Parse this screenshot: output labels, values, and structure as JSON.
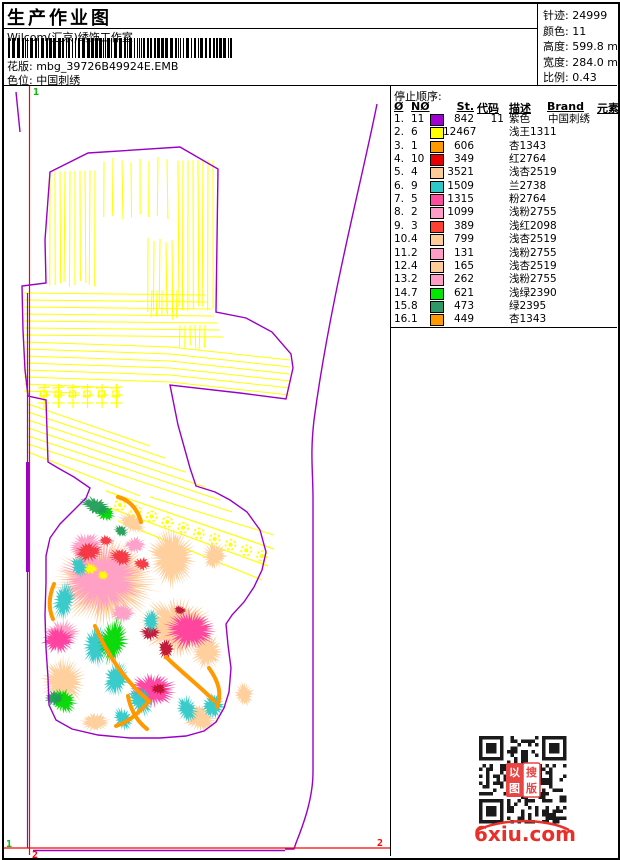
{
  "header": {
    "title": "生产作业图",
    "subtitle": "Wilcom(汇京)绣饰工作室",
    "pattern_label": "花版:",
    "pattern_value": "mbg_39726B49924E.EMB",
    "colorway_label": "色位:",
    "colorway_value": "中国刺绣"
  },
  "info": [
    {
      "label": "针迹",
      "value": "24999"
    },
    {
      "label": "颜色",
      "value": "11"
    },
    {
      "label": "高度",
      "value": "599.8 mm"
    },
    {
      "label": "宽度",
      "value": "284.0 mm"
    },
    {
      "label": "比例",
      "value": "0.43"
    }
  ],
  "stop_table": {
    "title": "停止顺序:",
    "headers": [
      "Ø",
      "NØ",
      "St.",
      "代码",
      "描述",
      "Brand",
      "元素"
    ],
    "rows": [
      {
        "no": "1.",
        "needle": "11",
        "color": "#A000D0",
        "st": "842",
        "code": "11",
        "desc": "紫色",
        "brand": "中国刺绣"
      },
      {
        "no": "2.",
        "needle": "6",
        "color": "#FFFF00",
        "st": "12467",
        "code": "",
        "desc": "浅王1311",
        "brand": ""
      },
      {
        "no": "3.",
        "needle": "1",
        "color": "#FF9900",
        "st": "606",
        "code": "",
        "desc": "杏1343",
        "brand": ""
      },
      {
        "no": "4.",
        "needle": "10",
        "color": "#E80000",
        "st": "349",
        "code": "",
        "desc": "红2764",
        "brand": ""
      },
      {
        "no": "5.",
        "needle": "4",
        "color": "#FFCC99",
        "st": "3521",
        "code": "",
        "desc": "浅杏2519",
        "brand": ""
      },
      {
        "no": "6.",
        "needle": "9",
        "color": "#2FC8C8",
        "st": "1509",
        "code": "",
        "desc": "兰2738",
        "brand": ""
      },
      {
        "no": "7.",
        "needle": "5",
        "color": "#FF4D9E",
        "st": "1315",
        "code": "",
        "desc": "粉2764",
        "brand": ""
      },
      {
        "no": "8.",
        "needle": "2",
        "color": "#FF9DC6",
        "st": "1099",
        "code": "",
        "desc": "浅粉2755",
        "brand": ""
      },
      {
        "no": "9.",
        "needle": "3",
        "color": "#FF4033",
        "st": "389",
        "code": "",
        "desc": "浅红2098",
        "brand": ""
      },
      {
        "no": "10.",
        "needle": "4",
        "color": "#FFCC99",
        "st": "799",
        "code": "",
        "desc": "浅杏2519",
        "brand": ""
      },
      {
        "no": "11.",
        "needle": "2",
        "color": "#FF9DC6",
        "st": "131",
        "code": "",
        "desc": "浅粉2755",
        "brand": ""
      },
      {
        "no": "12.",
        "needle": "4",
        "color": "#FFCC99",
        "st": "165",
        "code": "",
        "desc": "浅杏2519",
        "brand": ""
      },
      {
        "no": "13.",
        "needle": "2",
        "color": "#FF9DC6",
        "st": "262",
        "code": "",
        "desc": "浅粉2755",
        "brand": ""
      },
      {
        "no": "14.",
        "needle": "7",
        "color": "#00E800",
        "st": "621",
        "code": "",
        "desc": "浅绿2390",
        "brand": ""
      },
      {
        "no": "15.",
        "needle": "8",
        "color": "#2E9966",
        "st": "473",
        "code": "",
        "desc": "绿2395",
        "brand": ""
      },
      {
        "no": "16.",
        "needle": "1",
        "color": "#FF9900",
        "st": "449",
        "code": "",
        "desc": "杏1343",
        "brand": ""
      }
    ]
  },
  "watermark": "6xiu.com",
  "qr": {
    "stamp_tl": "以",
    "stamp_tr": "搜",
    "stamp_bl": "图",
    "stamp_br": "版"
  },
  "design": {
    "outline_color": "#9A00C8",
    "hatch_color": "#FFFF00",
    "guide_red": "#FF0000",
    "marker_green": "#00BB00",
    "outline_path": "M50,172 L88,153 L180,147 L218,169 L216,312 L246,318 L272,332 L291,354 L293,368 L286,399 L240,393 L170,385 L178,425 L190,468 L196,486 L215,492 L230,500 L247,512 L260,530 L266,552 L262,570 L254,587 L244,602 L232,615 L226,624 L228,645 L231,668 L229,692 L224,708 L216,722 L204,731 L186,736 L160,738 L130,738 L98,735 L72,729 L56,720 L49,705 L48,678 L46,648 L45,615 L46,582 L46,556 L50,538 L60,524 L74,510 L86,498 L90,488 L74,477 L58,468 L48,462 L47,430 L46,400 L28,396 L25,370 L23,330 L22,286 L46,283 L45,240 L50,172 Z",
    "right_curve": "M377,104 C362,180 330,300 314,420 C310,455 313,470 313,500 L313,772 C313,800 302,828 296,843 L294,849 L285,849",
    "purple_dash_top": "M16,92 L20,132",
    "purple_vline": {
      "x": 27.5,
      "y1": 293,
      "y2": 848,
      "thick_y1": 462,
      "thick_y2": 572
    },
    "red_vline": {
      "x": 29.5,
      "y1": 86,
      "y2": 855
    },
    "red_hline": {
      "y": 848,
      "x1": 4,
      "x2": 390
    },
    "purple_hline": {
      "y": 850.5,
      "x1": 33,
      "x2": 285
    },
    "vhatch": [
      {
        "x0": 50,
        "x1": 96,
        "step": 5,
        "y0": 170,
        "y1": 287
      },
      {
        "x0": 178,
        "x1": 214,
        "step": 5,
        "y0": 155,
        "y1": 311
      },
      {
        "x0": 148,
        "x1": 173,
        "step": 6,
        "y0": 237,
        "y1": 313
      },
      {
        "x0": 104,
        "x1": 168,
        "step": 9,
        "y0": 157,
        "y1": 220
      },
      {
        "x0": 152,
        "x1": 178,
        "step": 5,
        "y0": 289,
        "y1": 320
      },
      {
        "x0": 180,
        "x1": 206,
        "step": 5,
        "y0": 320,
        "y1": 350
      }
    ],
    "hhatch": {
      "count": 7,
      "y0": 293,
      "dy": 7,
      "x0": 24,
      "x1": 205,
      "dx1": 3
    },
    "diag_band": {
      "count": 6,
      "y0": 342,
      "dy": 7,
      "x0": 24,
      "mx": 170,
      "x1": 290,
      "mdy": 5,
      "edy": 18
    },
    "short_lines": [
      [
        24,
        384,
        120,
        388
      ],
      [
        24,
        391,
        80,
        393
      ]
    ],
    "diag_lower": [
      [
        28,
        404,
        150,
        446
      ],
      [
        28,
        412,
        165,
        458
      ],
      [
        28,
        420,
        185,
        472
      ],
      [
        28,
        428,
        205,
        487
      ],
      [
        28,
        436,
        220,
        500
      ],
      [
        28,
        444,
        232,
        512
      ],
      [
        28,
        452,
        140,
        496
      ],
      [
        150,
        497,
        274,
        535
      ]
    ],
    "dollar_band": {
      "edges": [
        [
          106,
          491,
          274,
          549
        ],
        [
          110,
          508,
          268,
          566
        ],
        [
          118,
          521,
          262,
          580
        ]
      ],
      "rosette_line": [
        120,
        505,
        262,
        556
      ],
      "rosette_count": 10
    },
    "glyph_row": {
      "x0": 38,
      "y0": 384,
      "count": 6,
      "step": 14.5,
      "h": 26
    },
    "markers": [
      {
        "t": "1",
        "x": 33,
        "y": 95,
        "c": "#00BB00"
      },
      {
        "t": "1",
        "x": 6,
        "y": 847,
        "c": "#00BB00"
      },
      {
        "t": "2",
        "x": 32,
        "y": 858,
        "c": "#FF0000"
      },
      {
        "t": "2",
        "x": 377,
        "y": 846,
        "c": "#FF0000"
      }
    ],
    "stems_color": "#FF9900",
    "stems": [
      "M118,497 C130,500 138,510 141,522",
      "M95,626 C108,656 126,682 149,701",
      "M149,701 C138,714 128,722 116,726",
      "M166,657 C186,676 204,690 214,701",
      "M54,584 C49,596 48,608 53,619",
      "M209,668 C219,682 222,694 217,707",
      "M128,696 C131,712 138,722 147,729"
    ],
    "blobs": [
      [
        "#FFCC99",
        105,
        582,
        54,
        46,
        0
      ],
      [
        "#FFCC99",
        178,
        628,
        40,
        30,
        15
      ],
      [
        "#FFCC99",
        172,
        558,
        24,
        32,
        -10
      ],
      [
        "#FFCC99",
        63,
        682,
        22,
        27,
        0
      ],
      [
        "#FFCC99",
        200,
        718,
        19,
        14,
        20
      ],
      [
        "#FFCC99",
        214,
        556,
        13,
        15,
        0
      ],
      [
        "#FFCC99",
        244,
        694,
        10,
        13,
        0
      ],
      [
        "#FFCC99",
        132,
        523,
        15,
        10,
        30
      ],
      [
        "#FFCC99",
        207,
        652,
        17,
        19,
        0
      ],
      [
        "#FFCC99",
        95,
        722,
        16,
        10,
        0
      ],
      [
        "#FF9DC6",
        102,
        578,
        42,
        37,
        0
      ],
      [
        "#FF9DC6",
        86,
        546,
        19,
        14,
        -15
      ],
      [
        "#FF9DC6",
        62,
        634,
        18,
        15,
        0
      ],
      [
        "#FF9DC6",
        123,
        613,
        13,
        10,
        0
      ],
      [
        "#FF9DC6",
        135,
        545,
        12,
        9,
        0
      ],
      [
        "#F5333F",
        88,
        552,
        15,
        10,
        -10
      ],
      [
        "#F5333F",
        121,
        557,
        13,
        9,
        10
      ],
      [
        "#F5333F",
        142,
        564,
        9,
        7,
        0
      ],
      [
        "#F5333F",
        106,
        541,
        8,
        6,
        0
      ],
      [
        "#FFFF00",
        90,
        569,
        9,
        6,
        0
      ],
      [
        "#FFFF00",
        103,
        575,
        6,
        5,
        0
      ],
      [
        "#FF3D9E",
        190,
        630,
        27,
        21,
        10
      ],
      [
        "#FF3D9E",
        152,
        690,
        25,
        18,
        0
      ],
      [
        "#FF3D9E",
        58,
        640,
        17,
        14,
        0
      ],
      [
        "#C01030",
        150,
        633,
        11,
        8,
        0
      ],
      [
        "#C01030",
        166,
        649,
        8,
        11,
        0
      ],
      [
        "#C01030",
        159,
        689,
        9,
        6,
        0
      ],
      [
        "#C01030",
        180,
        610,
        7,
        5,
        0
      ],
      [
        "#2FC8C8",
        64,
        601,
        11,
        20,
        10
      ],
      [
        "#2FC8C8",
        79,
        566,
        8,
        12,
        -15
      ],
      [
        "#2FC8C8",
        96,
        646,
        13,
        22,
        8
      ],
      [
        "#2FC8C8",
        116,
        679,
        12,
        20,
        18
      ],
      [
        "#2FC8C8",
        141,
        701,
        17,
        12,
        65
      ],
      [
        "#2FC8C8",
        123,
        719,
        13,
        9,
        55
      ],
      [
        "#2FC8C8",
        187,
        709,
        15,
        11,
        70
      ],
      [
        "#2FC8C8",
        213,
        706,
        12,
        14,
        25
      ],
      [
        "#2FC8C8",
        151,
        621,
        9,
        13,
        0
      ],
      [
        "#00D800",
        113,
        641,
        15,
        25,
        10
      ],
      [
        "#00D800",
        63,
        701,
        15,
        12,
        35
      ],
      [
        "#00D800",
        105,
        513,
        11,
        8,
        20
      ],
      [
        "#1F9E55",
        96,
        506,
        17,
        9,
        20
      ],
      [
        "#1F9E55",
        54,
        698,
        10,
        8,
        0
      ],
      [
        "#1F9E55",
        121,
        531,
        9,
        6,
        30
      ]
    ]
  }
}
